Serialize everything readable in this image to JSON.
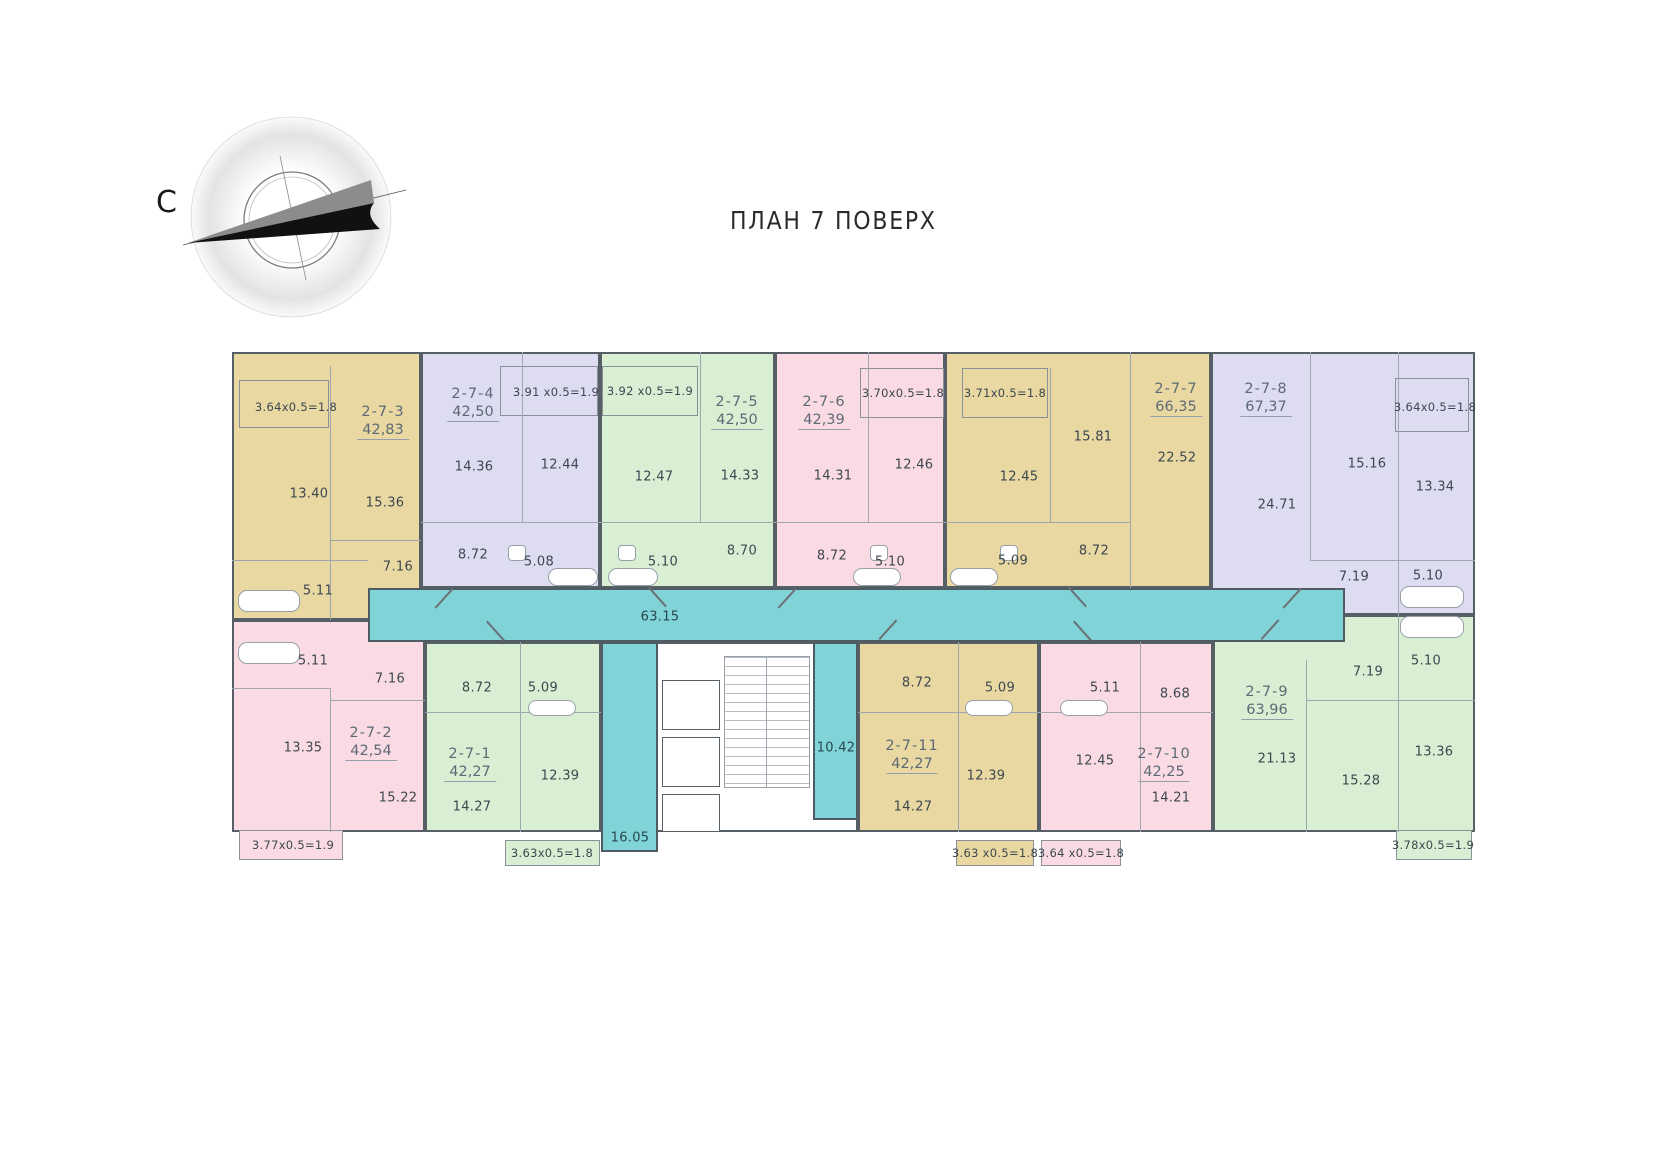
{
  "title": "ПЛАН 7 ПОВЕРХ",
  "compass": {
    "north_label": "С"
  },
  "colors": {
    "apartment_yellow": "#e9d8a2",
    "apartment_lavender": "#dddcf1",
    "apartment_green": "#d9efd3",
    "apartment_pink": "#fbdbe3",
    "corridor_teal": "#80d3d7"
  },
  "corridor": {
    "area": "63.15"
  },
  "lobby_left": {
    "area": "16.05"
  },
  "lobby_right": {
    "area": "10.42"
  },
  "apartments": {
    "a2_7_3": {
      "number": "2-7-3",
      "total_area": "42,83",
      "balcony": "3.64x0.5=1.8",
      "rooms": {
        "kitchen": "13.40",
        "living": "15.36",
        "hall": "7.16",
        "bath": "5.11"
      }
    },
    "a2_7_4": {
      "number": "2-7-4",
      "total_area": "42,50",
      "balcony": "3.91 x0.5=1.9",
      "rooms": {
        "living": "14.36",
        "kitchen": "12.44",
        "hall": "8.72",
        "bath": "5.08"
      }
    },
    "a2_7_5": {
      "number": "2-7-5",
      "total_area": "42,50",
      "balcony": "3.92 x0.5=1.9",
      "rooms": {
        "kitchen": "12.47",
        "living": "14.33",
        "hall": "8.70",
        "bath": "5.10"
      }
    },
    "a2_7_6": {
      "number": "2-7-6",
      "total_area": "42,39",
      "balcony": "3.70x0.5=1.8",
      "rooms": {
        "living": "14.31",
        "kitchen": "12.46",
        "hall": "8.72",
        "bath": "5.10"
      }
    },
    "a2_7_7": {
      "number": "2-7-7",
      "total_area": "66,35",
      "balcony": "3.71x0.5=1.8",
      "rooms": {
        "bedroom": "15.81",
        "living": "22.52",
        "kitchen": "12.45",
        "hall": "8.72",
        "bath": "5.09"
      }
    },
    "a2_7_8": {
      "number": "2-7-8",
      "total_area": "67,37",
      "balcony": "3.64x0.5=1.8",
      "rooms": {
        "living": "24.71",
        "bedroom": "15.16",
        "kitchen": "13.34",
        "hall": "7.19",
        "bath": "5.10"
      }
    },
    "a2_7_2": {
      "number": "2-7-2",
      "total_area": "42,54",
      "balcony": "3.77x0.5=1.9",
      "rooms": {
        "bath": "5.11",
        "hall": "7.16",
        "kitchen": "13.35",
        "living": "15.22"
      }
    },
    "a2_7_1": {
      "number": "2-7-1",
      "total_area": "42,27",
      "balcony": "3.63x0.5=1.8",
      "rooms": {
        "hall": "8.72",
        "bath": "5.09",
        "kitchen": "12.39",
        "living": "14.27"
      }
    },
    "a2_7_11": {
      "number": "2-7-11",
      "total_area": "42,27",
      "balcony": "3.63 x0.5=1.8",
      "rooms": {
        "hall": "8.72",
        "bath": "5.09",
        "kitchen": "12.39",
        "living": "14.27"
      }
    },
    "a2_7_10": {
      "number": "2-7-10",
      "total_area": "42,25",
      "balcony": "3.64 x0.5=1.8",
      "rooms": {
        "bath": "5.11",
        "hall": "8.68",
        "kitchen": "12.45",
        "living": "14.21"
      }
    },
    "a2_7_9": {
      "number": "2-7-9",
      "total_area": "63,96",
      "balcony": "3.78x0.5=1.9",
      "rooms": {
        "living": "21.13",
        "bedroom": "15.28",
        "hall": "7.19",
        "bath": "5.10",
        "kitchen": "13.36"
      }
    }
  }
}
